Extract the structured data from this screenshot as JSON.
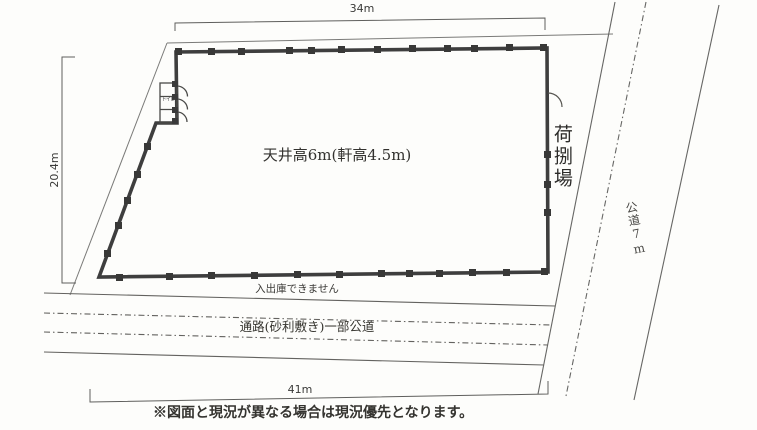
{
  "plan": {
    "title_hint": "warehouse-site-plan",
    "dimensions": {
      "top": "34m",
      "left": "20.4m",
      "bottom": "41m"
    },
    "labels": {
      "ceiling_height": "天井高6m(軒高4.5m)",
      "loading_dock": "荷捌場",
      "public_road": "公道7m",
      "no_access": "入出庫できません",
      "passage": "通路(砂利敷き)一部公道",
      "toilet": "トイレ",
      "note": "※図面と現況が異なる場合は現況優先となります。"
    },
    "colors": {
      "paper": "#fdfdfb",
      "wall": "#3e3e3e",
      "thin_line": "#6e6e6c",
      "road_line": "#5c5c5a",
      "text": "#2e2d2b"
    }
  }
}
